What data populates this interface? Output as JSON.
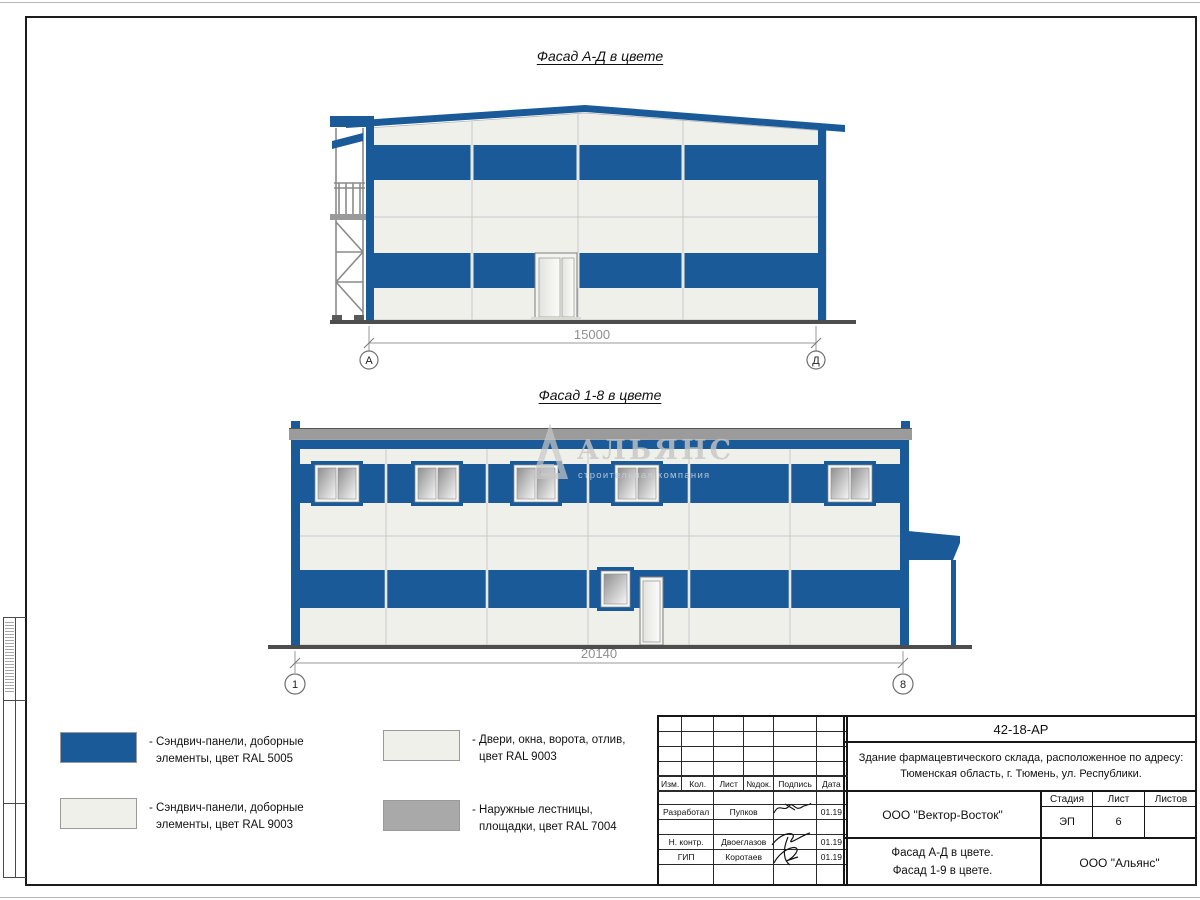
{
  "colors": {
    "ral5005_blue": "#1b5a98",
    "ral9003_white": "#f0f0eb",
    "ral7004_grey": "#a9a9a9",
    "roof_grey": "#9b9b9b",
    "ground": "#4d4d4d"
  },
  "watermark": {
    "name": "АЛЬЯНС",
    "subtitle": "строительная компания"
  },
  "drawings": {
    "facade_ad": {
      "title": "Фасад А-Д в цвете",
      "dimension": "15000",
      "axis_left": "А",
      "axis_right": "Д"
    },
    "facade_18": {
      "title": "Фасад 1-8 в цвете",
      "dimension": "20140",
      "axis_left": "1",
      "axis_right": "8"
    }
  },
  "legend": {
    "items": [
      {
        "name": "ral5005-panels",
        "color": "#1b5a98",
        "line1": "- Сэндвич-панели, доборные",
        "line2": "элементы, цвет RAL 5005"
      },
      {
        "name": "ral9003-panels",
        "color": "#f0f0eb",
        "line1": "- Сэндвич-панели, доборные",
        "line2": "элементы, цвет RAL 9003"
      },
      {
        "name": "ral9003-doors",
        "color": "#f0f0eb",
        "line1": "- Двери, окна, ворота, отлив,",
        "line2": "цвет RAL 9003"
      },
      {
        "name": "ral7004-stairs",
        "color": "#a9a9a9",
        "line1": "- Наружные лестницы,",
        "line2": "площадки, цвет RAL 7004"
      }
    ]
  },
  "title_block": {
    "doc_number": "42-18-АР",
    "project_line1": "Здание фармацевтического склада, расположенное по адресу:",
    "project_line2": "Тюменская область, г. Тюмень, ул. Республики.",
    "columns": [
      "Изм.",
      "Кол.",
      "Лист",
      "№док.",
      "Подпись",
      "Дата"
    ],
    "rows": [
      {
        "role": "Разработал",
        "name": "Пупков",
        "date": "01.19"
      },
      {
        "role": "Н. контр.",
        "name": "Двоеглазов",
        "date": "01.19"
      },
      {
        "role": "ГИП",
        "name": "Коротаев",
        "date": "01.19"
      }
    ],
    "designer_org": "ООО \"Вектор-Восток\"",
    "stage_label": "Стадия",
    "sheet_label": "Лист",
    "sheets_label": "Листов",
    "stage": "ЭП",
    "sheet": "6",
    "sheets": "",
    "sheet_title_line1": "Фасад А-Д в цвете.",
    "sheet_title_line2": "Фасад 1-9 в цвете.",
    "org": "ООО \"Альянс\""
  }
}
